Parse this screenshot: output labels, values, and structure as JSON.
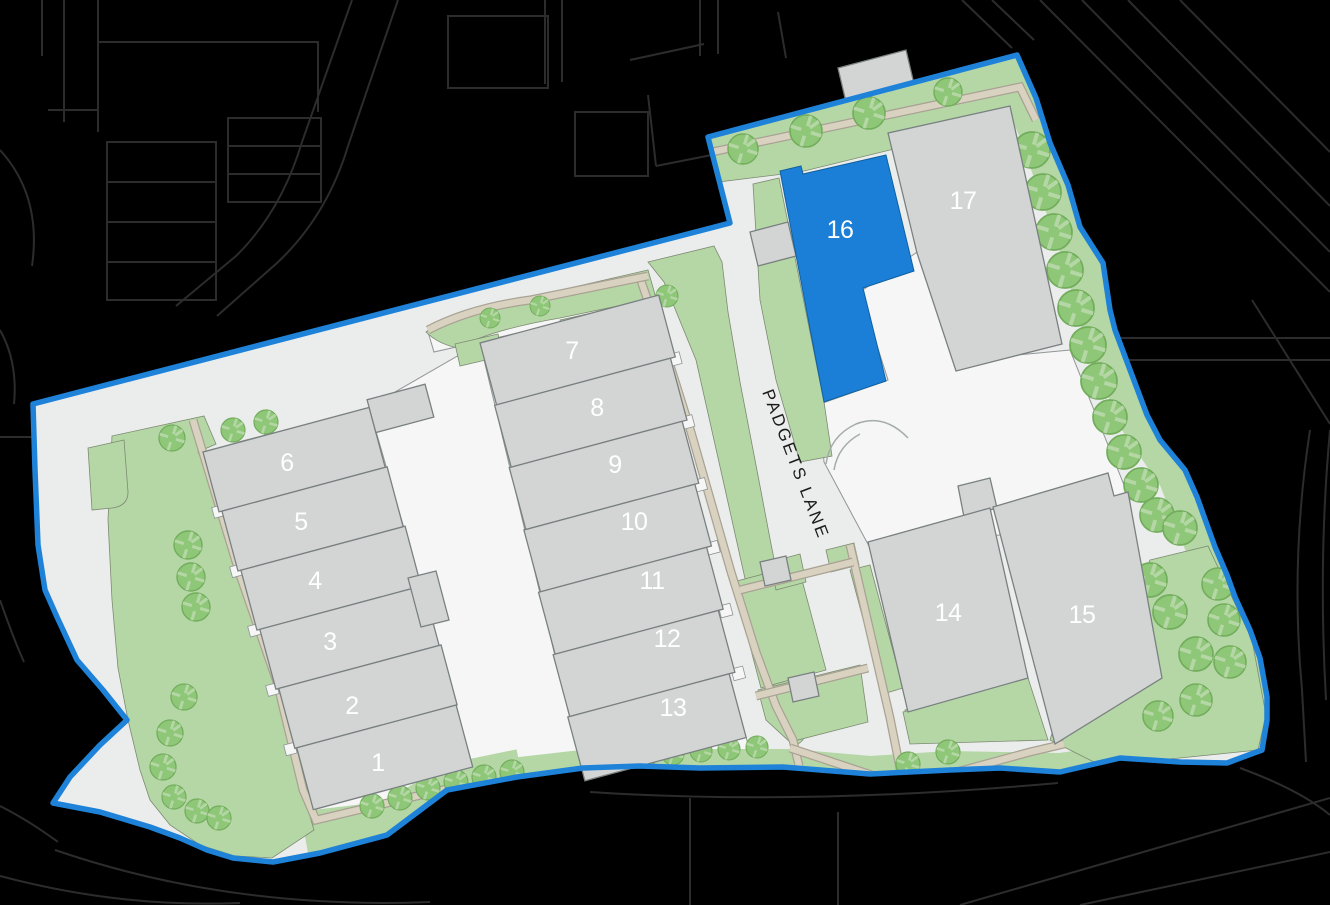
{
  "map": {
    "road_label": "PADGETS LANE",
    "units": [
      {
        "label": "1",
        "highlighted": false
      },
      {
        "label": "2",
        "highlighted": false
      },
      {
        "label": "3",
        "highlighted": false
      },
      {
        "label": "4",
        "highlighted": false
      },
      {
        "label": "5",
        "highlighted": false
      },
      {
        "label": "6",
        "highlighted": false
      },
      {
        "label": "7",
        "highlighted": false
      },
      {
        "label": "8",
        "highlighted": false
      },
      {
        "label": "9",
        "highlighted": false
      },
      {
        "label": "10",
        "highlighted": false
      },
      {
        "label": "11",
        "highlighted": false
      },
      {
        "label": "12",
        "highlighted": false
      },
      {
        "label": "13",
        "highlighted": false
      },
      {
        "label": "14",
        "highlighted": false
      },
      {
        "label": "15",
        "highlighted": false
      },
      {
        "label": "16",
        "highlighted": true
      },
      {
        "label": "17",
        "highlighted": false
      }
    ],
    "colors": {
      "background": "#000000",
      "site_ground": "#ebedec",
      "building": "#d2d5d4",
      "building_light": "#f5f6f5",
      "highlight": "#1b7ed7",
      "boundary": "#1e82d9",
      "landscape": "#b5d7a6",
      "tree": "#8ec778",
      "footpath": "#d9d2c0",
      "road_lines": "#2c2c2c",
      "unit_label_text": "#ffffff",
      "road_label_text": "#1b1b19"
    }
  }
}
